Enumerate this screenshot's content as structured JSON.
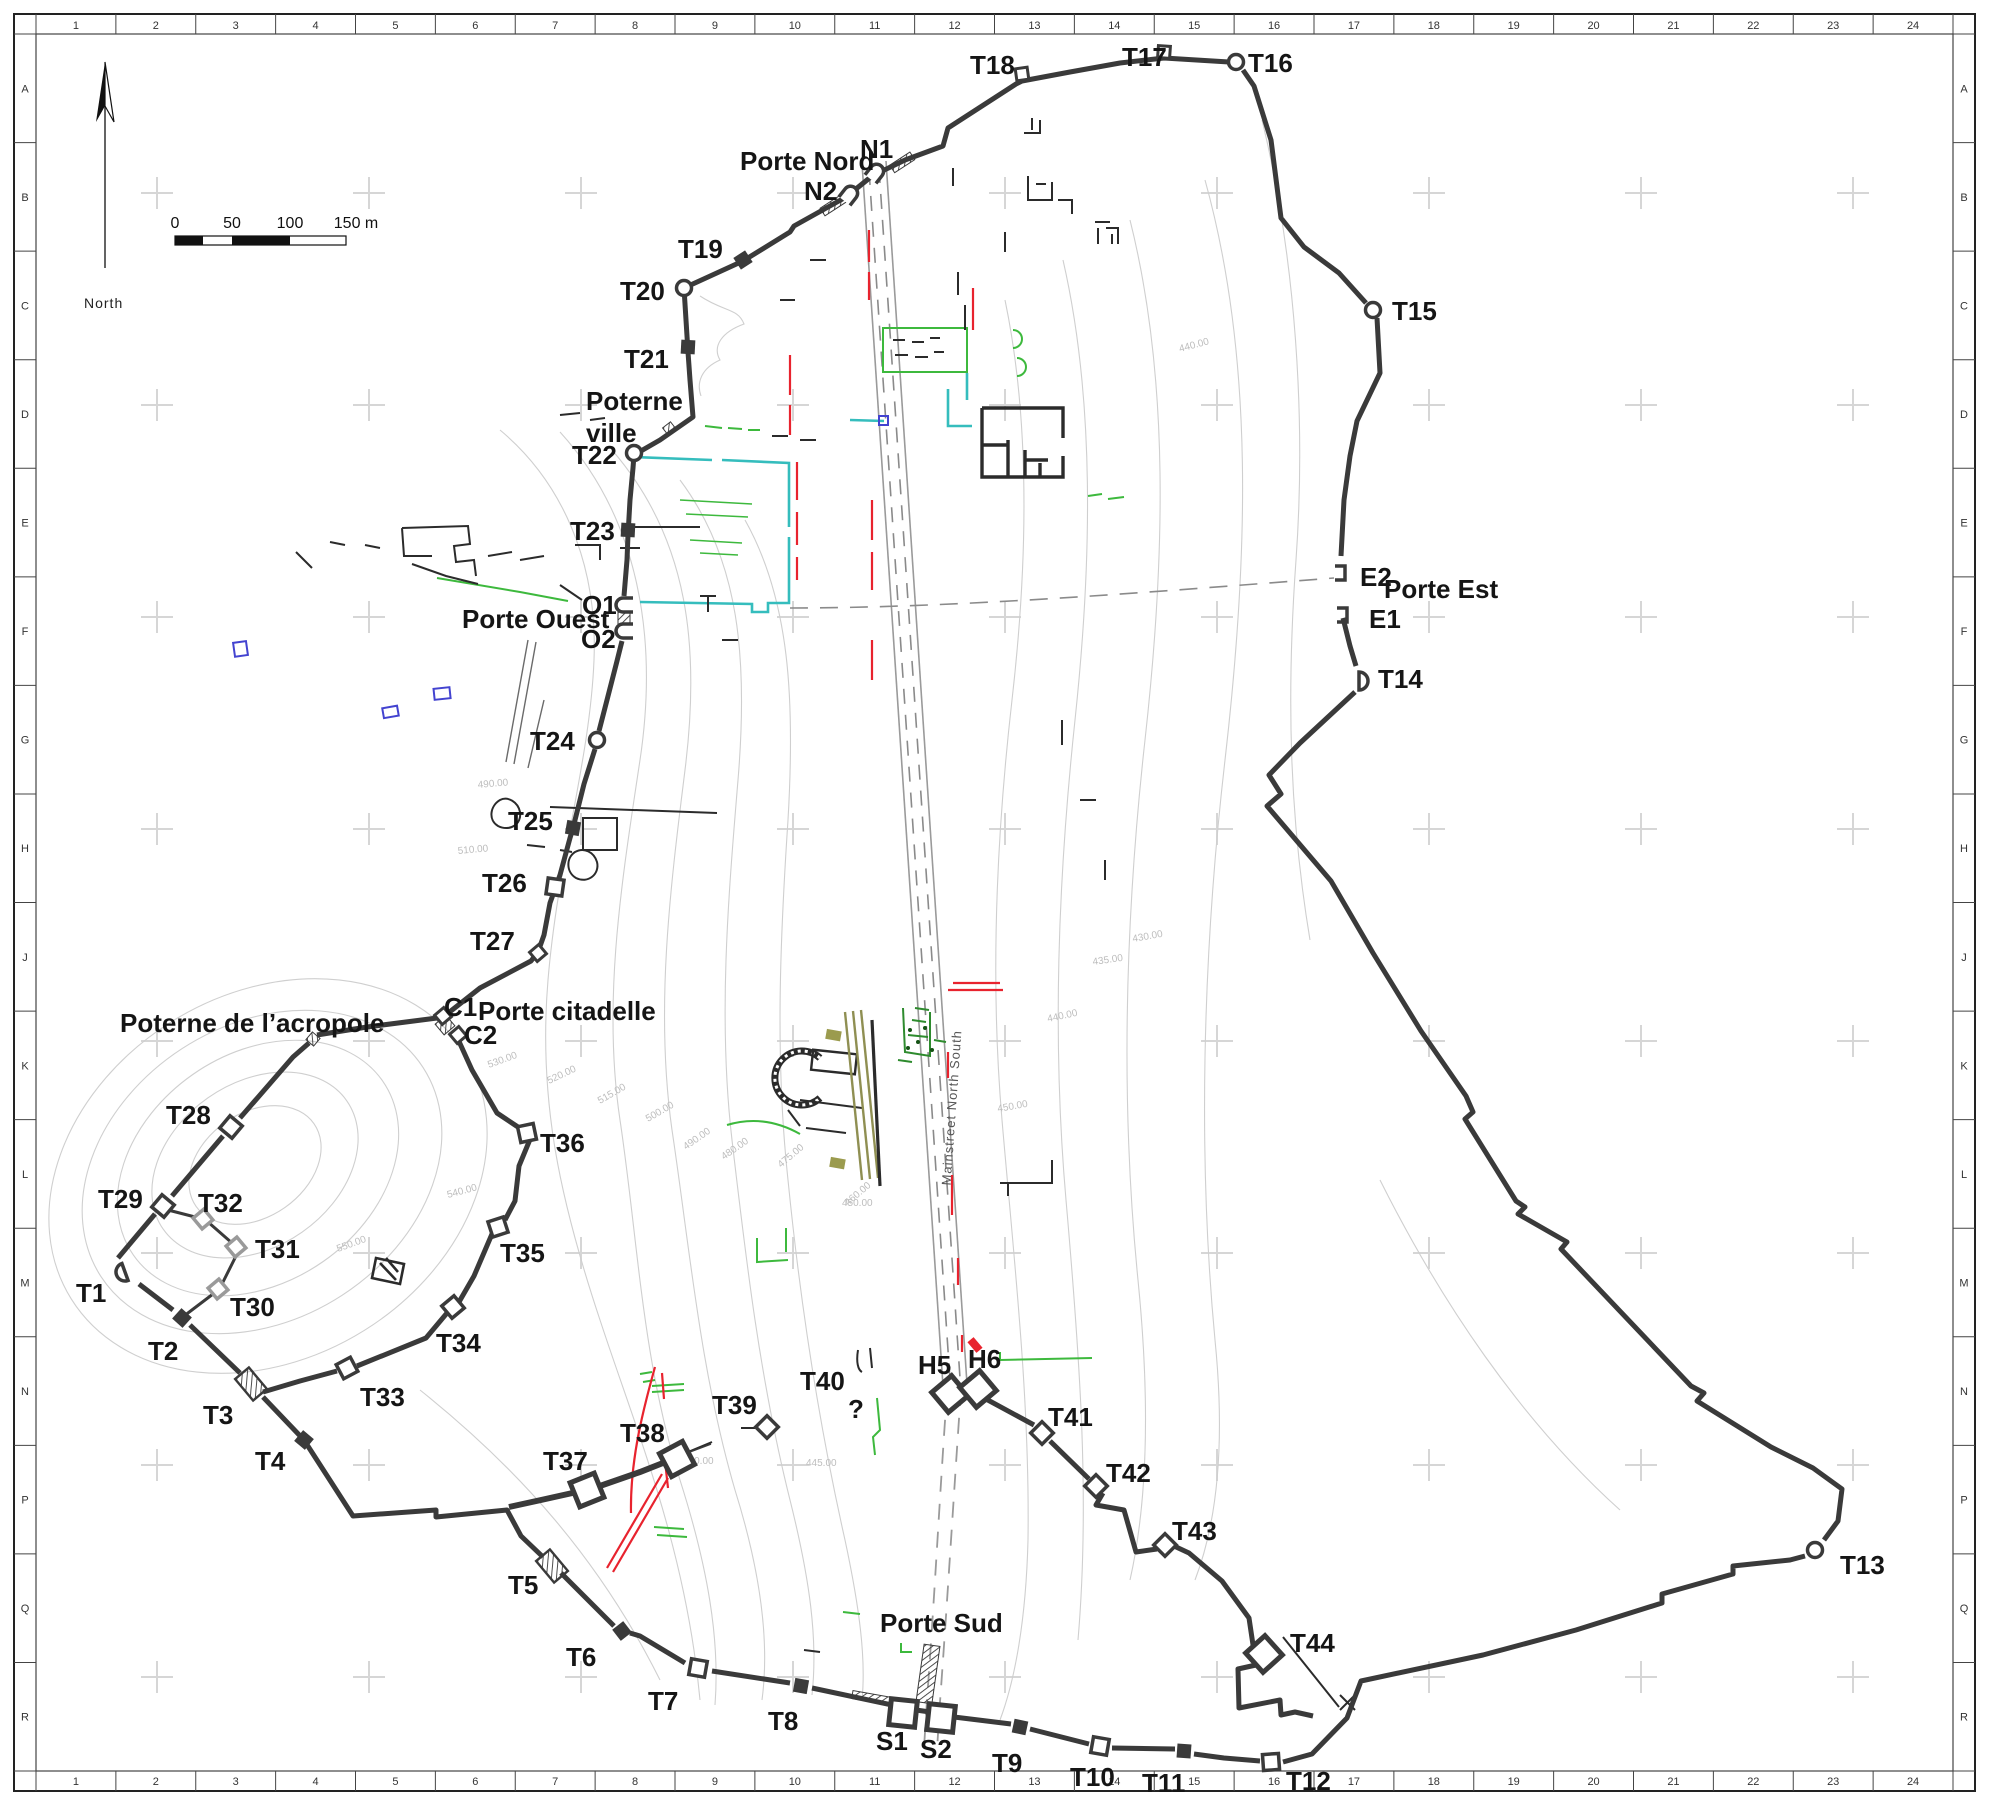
{
  "colors": {
    "wall": "#3a3a3a",
    "contour": "#cfcfcf",
    "cross": "#d6d6d6",
    "red": "#e8232e",
    "green": "#3db93d",
    "dark_green": "#1e7a1e",
    "cyan": "#35bdbd",
    "blue": "#4343d0",
    "olive": "#8f8f52",
    "gray_tower": "#9a9a9a",
    "road": "#9a9a9a"
  },
  "compass": {
    "label": "North"
  },
  "scalebar": {
    "labels": [
      {
        "text": "0",
        "x": 175
      },
      {
        "text": "50",
        "x": 232
      },
      {
        "text": "100",
        "x": 290
      },
      {
        "text": "150 m",
        "x": 356
      }
    ]
  },
  "grid": {
    "columns": [
      "1",
      "2",
      "3",
      "4",
      "5",
      "6",
      "7",
      "8",
      "9",
      "10",
      "11",
      "12",
      "13",
      "14",
      "15",
      "16",
      "17",
      "18",
      "19",
      "20",
      "21",
      "22",
      "23",
      "24"
    ],
    "rows": [
      "A",
      "B",
      "C",
      "D",
      "E",
      "F",
      "G",
      "H",
      "J",
      "K",
      "L",
      "M",
      "N",
      "P",
      "Q",
      "R"
    ]
  },
  "street_label": {
    "text": "Mainstreet North South",
    "x": 956,
    "y": 1108,
    "rotation": -86
  },
  "gate_labels": [
    {
      "id": "porte-nord",
      "text": "Porte Nord",
      "x": 740,
      "y": 170
    },
    {
      "id": "porte-est",
      "text": "Porte Est",
      "x": 1384,
      "y": 598
    },
    {
      "id": "porte-ouest",
      "text": "Porte Ouest",
      "x": 462,
      "y": 628
    },
    {
      "id": "porte-sud",
      "text": "Porte Sud",
      "x": 880,
      "y": 1632
    },
    {
      "id": "porte-citadelle",
      "text": "Porte citadelle",
      "x": 478,
      "y": 1020
    },
    {
      "id": "poterne-ville-1",
      "text": "Poterne",
      "x": 586,
      "y": 410
    },
    {
      "id": "poterne-ville-2",
      "text": "ville",
      "x": 586,
      "y": 442
    },
    {
      "id": "poterne-acropole",
      "text": "Poterne de l’acropole",
      "x": 120,
      "y": 1032
    }
  ],
  "tower_labels": [
    {
      "id": "T1",
      "text": "T1",
      "x": 76,
      "y": 1302
    },
    {
      "id": "T2",
      "text": "T2",
      "x": 148,
      "y": 1360
    },
    {
      "id": "T3",
      "text": "T3",
      "x": 203,
      "y": 1424
    },
    {
      "id": "T4",
      "text": "T4",
      "x": 255,
      "y": 1470
    },
    {
      "id": "T5",
      "text": "T5",
      "x": 508,
      "y": 1594
    },
    {
      "id": "T6",
      "text": "T6",
      "x": 566,
      "y": 1666
    },
    {
      "id": "T7",
      "text": "T7",
      "x": 648,
      "y": 1710
    },
    {
      "id": "T8",
      "text": "T8",
      "x": 768,
      "y": 1730
    },
    {
      "id": "T9",
      "text": "T9",
      "x": 992,
      "y": 1772
    },
    {
      "id": "T10",
      "text": "T10",
      "x": 1070,
      "y": 1786
    },
    {
      "id": "T11",
      "text": "T11",
      "x": 1142,
      "y": 1792
    },
    {
      "id": "T12",
      "text": "T12",
      "x": 1286,
      "y": 1790
    },
    {
      "id": "T13",
      "text": "T13",
      "x": 1840,
      "y": 1574
    },
    {
      "id": "T14",
      "text": "T14",
      "x": 1378,
      "y": 688
    },
    {
      "id": "T15",
      "text": "T15",
      "x": 1392,
      "y": 320
    },
    {
      "id": "T16",
      "text": "T16",
      "x": 1248,
      "y": 72
    },
    {
      "id": "T17",
      "text": "T17",
      "x": 1122,
      "y": 66
    },
    {
      "id": "T18",
      "text": "T18",
      "x": 970,
      "y": 74
    },
    {
      "id": "T19",
      "text": "T19",
      "x": 678,
      "y": 258
    },
    {
      "id": "T20",
      "text": "T20",
      "x": 620,
      "y": 300
    },
    {
      "id": "T21",
      "text": "T21",
      "x": 624,
      "y": 368
    },
    {
      "id": "T22",
      "text": "T22",
      "x": 572,
      "y": 464
    },
    {
      "id": "T23",
      "text": "T23",
      "x": 570,
      "y": 540
    },
    {
      "id": "T24",
      "text": "T24",
      "x": 530,
      "y": 750
    },
    {
      "id": "T25",
      "text": "T25",
      "x": 508,
      "y": 830
    },
    {
      "id": "T26",
      "text": "T26",
      "x": 482,
      "y": 892
    },
    {
      "id": "T27",
      "text": "T27",
      "x": 470,
      "y": 950
    },
    {
      "id": "T28",
      "text": "T28",
      "x": 166,
      "y": 1124
    },
    {
      "id": "T29",
      "text": "T29",
      "x": 98,
      "y": 1208
    },
    {
      "id": "T30",
      "text": "T30",
      "x": 230,
      "y": 1316
    },
    {
      "id": "T31",
      "text": "T31",
      "x": 255,
      "y": 1258
    },
    {
      "id": "T32",
      "text": "T32",
      "x": 198,
      "y": 1212
    },
    {
      "id": "T33",
      "text": "T33",
      "x": 360,
      "y": 1406
    },
    {
      "id": "T34",
      "text": "T34",
      "x": 436,
      "y": 1352
    },
    {
      "id": "T35",
      "text": "T35",
      "x": 500,
      "y": 1262
    },
    {
      "id": "T36",
      "text": "T36",
      "x": 540,
      "y": 1152
    },
    {
      "id": "T37",
      "text": "T37",
      "x": 543,
      "y": 1470
    },
    {
      "id": "T38",
      "text": "T38",
      "x": 620,
      "y": 1442
    },
    {
      "id": "T39",
      "text": "T39",
      "x": 712,
      "y": 1414
    },
    {
      "id": "T40",
      "text": "T40",
      "x": 800,
      "y": 1390
    },
    {
      "id": "T41",
      "text": "T41",
      "x": 1048,
      "y": 1426
    },
    {
      "id": "T42",
      "text": "T42",
      "x": 1106,
      "y": 1482
    },
    {
      "id": "T43",
      "text": "T43",
      "x": 1172,
      "y": 1540
    },
    {
      "id": "T44",
      "text": "T44",
      "x": 1290,
      "y": 1652
    },
    {
      "id": "N1",
      "text": "N1",
      "x": 860,
      "y": 158
    },
    {
      "id": "N2",
      "text": "N2",
      "x": 804,
      "y": 200
    },
    {
      "id": "O1",
      "text": "O1",
      "x": 582,
      "y": 614
    },
    {
      "id": "O2",
      "text": "O2",
      "x": 581,
      "y": 648
    },
    {
      "id": "E1",
      "text": "E1",
      "x": 1369,
      "y": 628
    },
    {
      "id": "E2",
      "text": "E2",
      "x": 1360,
      "y": 586
    },
    {
      "id": "C1",
      "text": "C1",
      "x": 444,
      "y": 1016
    },
    {
      "id": "C2",
      "text": "C2",
      "x": 464,
      "y": 1044
    },
    {
      "id": "S1",
      "text": "S1",
      "x": 876,
      "y": 1750
    },
    {
      "id": "S2",
      "text": "S2",
      "x": 920,
      "y": 1758
    },
    {
      "id": "H5",
      "text": "H5",
      "x": 918,
      "y": 1374
    },
    {
      "id": "H6",
      "text": "H6",
      "x": 968,
      "y": 1368
    },
    {
      "id": "Q",
      "text": "?",
      "x": 848,
      "y": 1418
    }
  ],
  "towers": [
    {
      "id": "T1",
      "shape": "semi",
      "x": 125,
      "y": 1272,
      "angle": -110
    },
    {
      "id": "T2",
      "shape": "sq",
      "x": 182,
      "y": 1318,
      "angle": -48
    },
    {
      "id": "T3",
      "shape": "hatch",
      "x": 251,
      "y": 1384,
      "angle": -40
    },
    {
      "id": "T4",
      "shape": "sq",
      "x": 304,
      "y": 1440,
      "angle": -50
    },
    {
      "id": "T5",
      "shape": "hatch",
      "x": 552,
      "y": 1566,
      "angle": -40
    },
    {
      "id": "T6",
      "shape": "sq",
      "x": 622,
      "y": 1631,
      "angle": -38
    },
    {
      "id": "T7",
      "shape": "usq",
      "x": 698,
      "y": 1668,
      "angle": 10
    },
    {
      "id": "T8",
      "shape": "sq",
      "x": 801,
      "y": 1686,
      "angle": 10
    },
    {
      "id": "T9",
      "shape": "sq",
      "x": 1020,
      "y": 1727,
      "angle": 12
    },
    {
      "id": "T10",
      "shape": "usq",
      "x": 1100,
      "y": 1746,
      "angle": 10
    },
    {
      "id": "T11",
      "shape": "sq",
      "x": 1184,
      "y": 1751,
      "angle": 4
    },
    {
      "id": "T12",
      "shape": "usq",
      "x": 1271,
      "y": 1762,
      "angle": -4
    },
    {
      "id": "T13",
      "shape": "circle",
      "x": 1815,
      "y": 1550,
      "angle": 0
    },
    {
      "id": "T14",
      "shape": "semi",
      "x": 1359,
      "y": 681,
      "angle": 90
    },
    {
      "id": "T15",
      "shape": "circle",
      "x": 1373,
      "y": 310,
      "angle": 0
    },
    {
      "id": "T16",
      "shape": "circle",
      "x": 1236,
      "y": 62,
      "angle": 0
    },
    {
      "id": "T17",
      "shape": "usqs",
      "x": 1164,
      "y": 52,
      "angle": 4
    },
    {
      "id": "T18",
      "shape": "usqs",
      "x": 1022,
      "y": 74,
      "angle": -8
    },
    {
      "id": "T19",
      "shape": "sq",
      "x": 743,
      "y": 260,
      "angle": -33
    },
    {
      "id": "T20",
      "shape": "circle",
      "x": 684,
      "y": 288,
      "angle": 0
    },
    {
      "id": "T21",
      "shape": "sq",
      "x": 688,
      "y": 347,
      "angle": 3
    },
    {
      "id": "T22",
      "shape": "circle",
      "x": 634,
      "y": 453,
      "angle": 0
    },
    {
      "id": "T23",
      "shape": "sq",
      "x": 628,
      "y": 530,
      "angle": 3
    },
    {
      "id": "T24",
      "shape": "circle",
      "x": 597,
      "y": 740,
      "angle": 0
    },
    {
      "id": "T25",
      "shape": "sq",
      "x": 573,
      "y": 828,
      "angle": 10
    },
    {
      "id": "T26",
      "shape": "usq",
      "x": 555,
      "y": 887,
      "angle": 8
    },
    {
      "id": "T27",
      "shape": "usqs",
      "x": 538,
      "y": 953,
      "angle": -40
    },
    {
      "id": "T28",
      "shape": "usq",
      "x": 231,
      "y": 1127,
      "angle": -50
    },
    {
      "id": "T29",
      "shape": "usq",
      "x": 163,
      "y": 1206,
      "angle": -50
    },
    {
      "id": "T30",
      "shape": "gsq",
      "x": 218,
      "y": 1289,
      "angle": -40
    },
    {
      "id": "T31",
      "shape": "gsq",
      "x": 236,
      "y": 1247,
      "angle": -40
    },
    {
      "id": "T32",
      "shape": "gsq",
      "x": 203,
      "y": 1219,
      "angle": -40
    },
    {
      "id": "T33",
      "shape": "usq",
      "x": 347,
      "y": 1368,
      "angle": -28
    },
    {
      "id": "T34",
      "shape": "usq",
      "x": 453,
      "y": 1307,
      "angle": -40
    },
    {
      "id": "T35",
      "shape": "usq",
      "x": 498,
      "y": 1227,
      "angle": -18
    },
    {
      "id": "T36",
      "shape": "usq",
      "x": 527,
      "y": 1133,
      "angle": -12
    },
    {
      "id": "T37",
      "shape": "bigsq",
      "x": 587,
      "y": 1490,
      "angle": -22
    },
    {
      "id": "T38",
      "shape": "bigsq",
      "x": 677,
      "y": 1459,
      "angle": -28
    },
    {
      "id": "T39",
      "shape": "dia",
      "x": 767,
      "y": 1427,
      "angle": 0
    },
    {
      "id": "T41",
      "shape": "dia",
      "x": 1042,
      "y": 1433,
      "angle": 0
    },
    {
      "id": "T42",
      "shape": "dia",
      "x": 1096,
      "y": 1486,
      "angle": 0
    },
    {
      "id": "T43",
      "shape": "dia",
      "x": 1165,
      "y": 1545,
      "angle": 0
    },
    {
      "id": "T44",
      "shape": "bigsq",
      "x": 1264,
      "y": 1654,
      "angle": -42
    },
    {
      "id": "N1",
      "shape": "arch",
      "x": 876,
      "y": 172,
      "angle": 38
    },
    {
      "id": "N2",
      "shape": "arch",
      "x": 850,
      "y": 194,
      "angle": 38
    },
    {
      "id": "O1",
      "shape": "arch",
      "x": 624,
      "y": 605,
      "angle": -90
    },
    {
      "id": "O2",
      "shape": "arch",
      "x": 624,
      "y": 631,
      "angle": -90
    },
    {
      "id": "E1",
      "shape": "bracket",
      "x": 1343,
      "y": 615,
      "angle": 180
    },
    {
      "id": "E2",
      "shape": "bracket",
      "x": 1341,
      "y": 573,
      "angle": 180
    },
    {
      "id": "C1",
      "shape": "usqs",
      "x": 443,
      "y": 1016,
      "angle": -40
    },
    {
      "id": "C2",
      "shape": "usqs",
      "x": 458,
      "y": 1035,
      "angle": -40
    },
    {
      "id": "S1",
      "shape": "bigsq",
      "x": 903,
      "y": 1713,
      "angle": 6
    },
    {
      "id": "S2",
      "shape": "bigsq",
      "x": 941,
      "y": 1718,
      "angle": 6
    },
    {
      "id": "H5",
      "shape": "bigsq",
      "x": 950,
      "y": 1394,
      "angle": -40
    },
    {
      "id": "H6",
      "shape": "bigsq",
      "x": 978,
      "y": 1389,
      "angle": -40
    }
  ],
  "contour_labels": [
    {
      "text": "440.00",
      "x": 1180,
      "y": 352,
      "angle": -15
    },
    {
      "text": "435.00",
      "x": 1093,
      "y": 965,
      "angle": -8
    },
    {
      "text": "430.00",
      "x": 1133,
      "y": 942,
      "angle": -10
    },
    {
      "text": "440.00",
      "x": 1048,
      "y": 1022,
      "angle": -12
    },
    {
      "text": "450.00",
      "x": 998,
      "y": 1112,
      "angle": -10
    },
    {
      "text": "450.00",
      "x": 842,
      "y": 1206,
      "angle": 0
    },
    {
      "text": "445.00",
      "x": 806,
      "y": 1466,
      "angle": 0
    },
    {
      "text": "430.00",
      "x": 683,
      "y": 1464,
      "angle": 0
    },
    {
      "text": "490.00",
      "x": 478,
      "y": 788,
      "angle": -5
    },
    {
      "text": "510.00",
      "x": 458,
      "y": 854,
      "angle": -5
    },
    {
      "text": "530.00",
      "x": 489,
      "y": 1068,
      "angle": -20
    },
    {
      "text": "520.00",
      "x": 549,
      "y": 1084,
      "angle": -25
    },
    {
      "text": "515.00",
      "x": 600,
      "y": 1104,
      "angle": -30
    },
    {
      "text": "500.00",
      "x": 648,
      "y": 1122,
      "angle": -30
    },
    {
      "text": "490.00",
      "x": 686,
      "y": 1150,
      "angle": -35
    },
    {
      "text": "480.00",
      "x": 724,
      "y": 1160,
      "angle": -35
    },
    {
      "text": "475.00",
      "x": 781,
      "y": 1168,
      "angle": -40
    },
    {
      "text": "460.00",
      "x": 848,
      "y": 1206,
      "angle": -40
    },
    {
      "text": "540.00",
      "x": 448,
      "y": 1198,
      "angle": -15
    },
    {
      "text": "550.00",
      "x": 338,
      "y": 1252,
      "angle": -20
    }
  ]
}
